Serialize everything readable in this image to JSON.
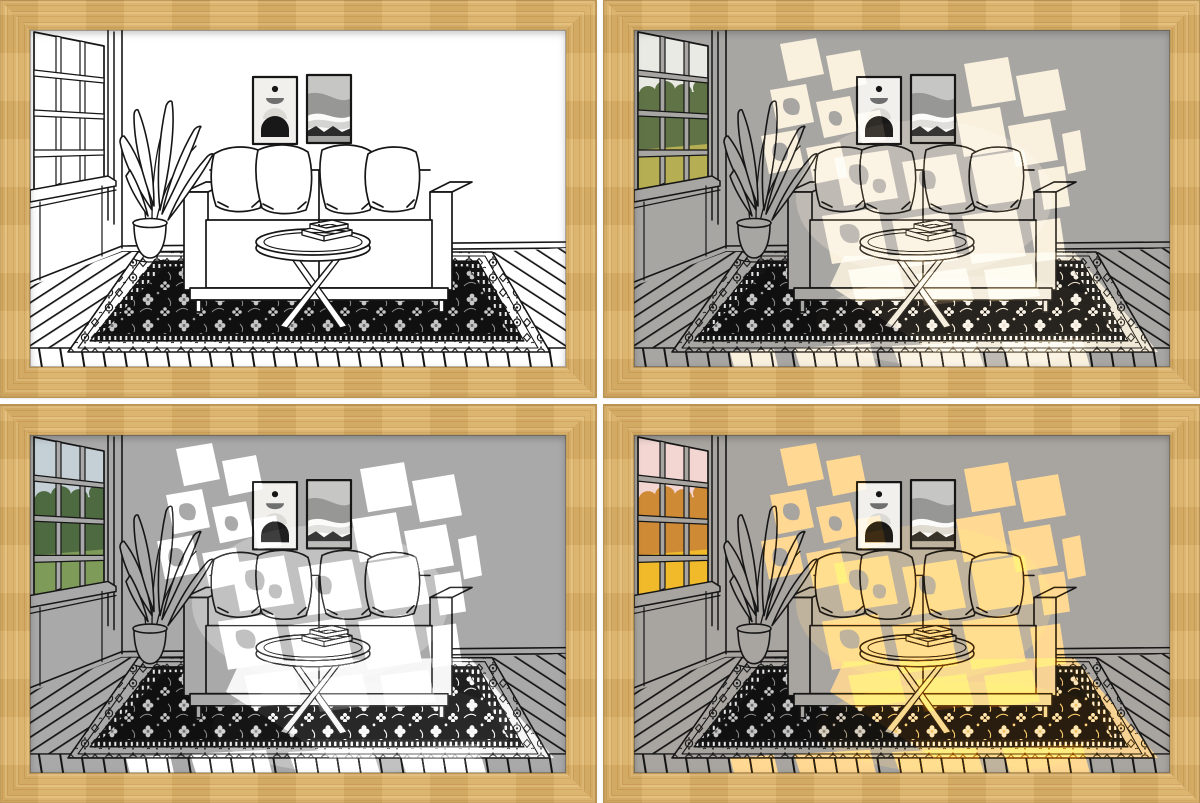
{
  "page": {
    "background": "#ffffff",
    "grid": {
      "rows": 2,
      "cols": 2,
      "gap_px": 8
    }
  },
  "frame": {
    "material": "light-oak-wood",
    "wood_base": "#d9b069",
    "wood_grain_dark": "#cfa25a",
    "wood_grain_light": "#e2bc7b",
    "wood_edge": "#b28b4b",
    "border_px": 30
  },
  "scene": {
    "ink": "#161616",
    "rug_field": "#101010",
    "rug_motif_light": "#c7c7c7",
    "art_arch_dark": "#181818",
    "art_waves_dark": "#2b2b2b",
    "elements": [
      "window",
      "window-view",
      "potted-plant",
      "sofa",
      "throw-pillows",
      "wall-art-arch",
      "wall-art-waves",
      "coffee-table",
      "books",
      "persian-rug",
      "wood-plank-floor",
      "sunlight-patches"
    ]
  },
  "panels": [
    {
      "id": "panel-line-art",
      "variant": "unlit-white",
      "colors": {
        "base": "#ffffff",
        "light": "#ffffff",
        "light_op": "0",
        "view_sky": "#ffffff",
        "view_trees": "#ffffff",
        "view_ground": "#ffffff"
      }
    },
    {
      "id": "panel-warm-daylight",
      "variant": "warm-white-glow",
      "colors": {
        "base": "#a8a6a3",
        "light": "#f7ead2",
        "light_op": "1",
        "view_sky": "#eaeae4",
        "view_trees": "#5f7347",
        "view_ground": "#b6ae52"
      }
    },
    {
      "id": "panel-cool-daylight",
      "variant": "white-glow",
      "colors": {
        "base": "#a9a9a9",
        "light": "#ffffff",
        "light_op": "1",
        "view_sky": "#c5d0d6",
        "view_trees": "#4e6a41",
        "view_ground": "#7e9b59"
      }
    },
    {
      "id": "panel-sunset",
      "variant": "golden-glow",
      "colors": {
        "base": "#a8a5a0",
        "light": "#ffc96e",
        "light_op": "1",
        "view_sky": "#f3d6d2",
        "view_trees": "#cf8a35",
        "view_ground": "#f0ba2b"
      }
    }
  ]
}
